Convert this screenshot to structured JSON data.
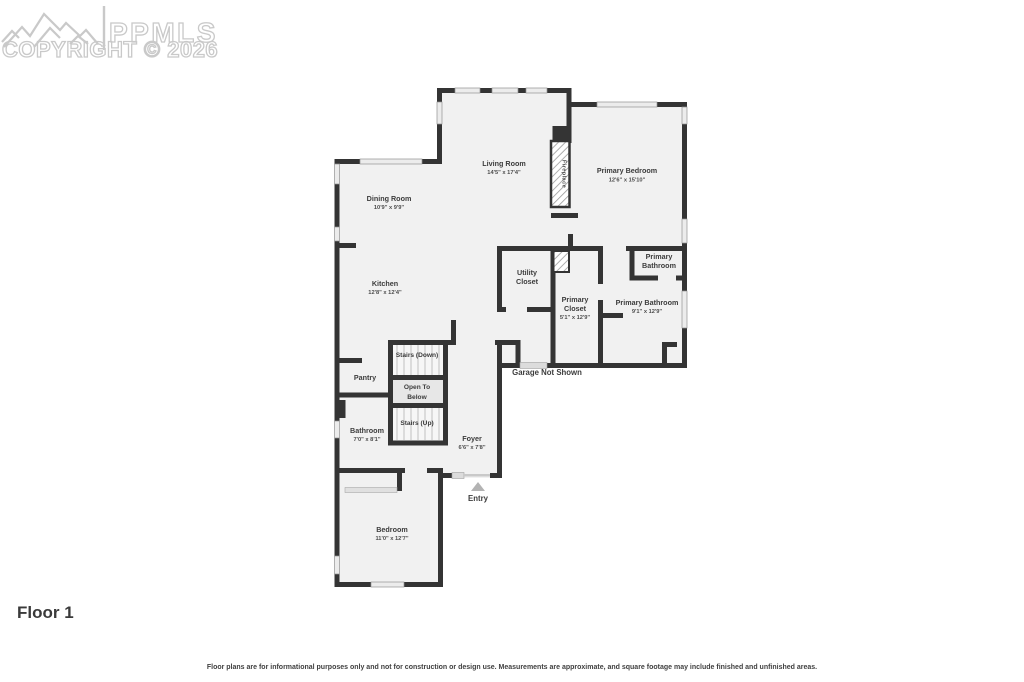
{
  "watermark": {
    "brand": "PPMLS",
    "copyright": "COPYRIGHT © 2026",
    "logo": "mountain-logo"
  },
  "floor_title": "Floor 1",
  "disclaimer": "Floor plans are for informational purposes only and not for construction or design use. Measurements are approximate, and square footage may include finished and unfinished areas.",
  "colors": {
    "wall": "#343434",
    "floor_fill": "#f1f1f1",
    "window_fill": "#ececec",
    "door_fill": "#dcdcdc",
    "watermark_gray": "#c9c9c9",
    "entry_arrow": "#b3b3b3"
  },
  "rooms": {
    "living_room": {
      "name": "Living Room",
      "dims": "14'5\" x 17'4\""
    },
    "dining_room": {
      "name": "Dining Room",
      "dims": "10'9\" x 9'9\""
    },
    "primary_bedroom": {
      "name": "Primary Bedroom",
      "dims": "12'6\" x 15'10\""
    },
    "kitchen": {
      "name": "Kitchen",
      "dims": "12'8\" x 12'4\""
    },
    "utility_closet": {
      "line1": "Utility",
      "line2": "Closet"
    },
    "primary_closet": {
      "line1": "Primary",
      "line2": "Closet",
      "dims": "5'1\" x 12'9\""
    },
    "primary_bathroom_wc": {
      "line1": "Primary",
      "line2": "Bathroom"
    },
    "primary_bathroom": {
      "name": "Primary Bathroom",
      "dims": "9'1\" x 12'9\""
    },
    "bathroom": {
      "name": "Bathroom",
      "dims": "7'0\" x 8'1\""
    },
    "pantry": {
      "name": "Pantry"
    },
    "foyer": {
      "name": "Foyer",
      "dims": "6'6\" x 7'8\""
    },
    "bedroom": {
      "name": "Bedroom",
      "dims": "11'0\" x 12'7\""
    },
    "stairs_down": {
      "name": "Stairs (Down)"
    },
    "stairs_up": {
      "name": "Stairs (Up)"
    },
    "open_to_below": {
      "line1": "Open To",
      "line2": "Below"
    },
    "fireplace": {
      "name": "Fireplace"
    },
    "entry": {
      "name": "Entry"
    },
    "garage_note": {
      "name": "Garage Not Shown"
    }
  }
}
